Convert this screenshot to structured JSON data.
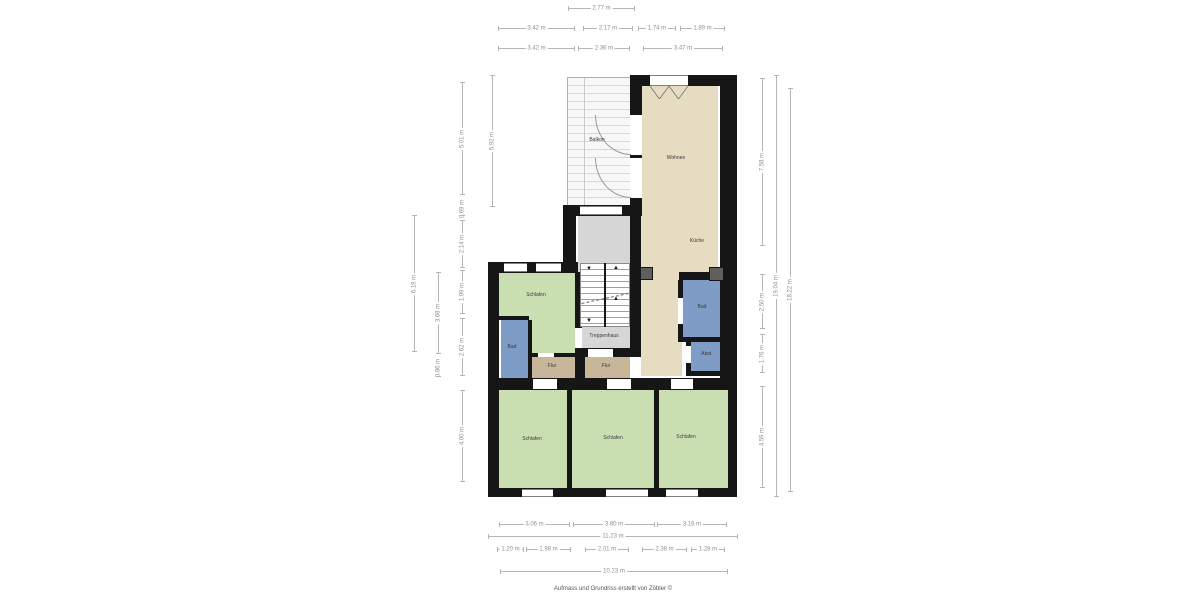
{
  "footer": {
    "credit": "Aufmass und Grundriss erstellt von Zöbler ©"
  },
  "colors": {
    "wall": "#161616",
    "living": "#e5dcc1",
    "bedroom": "#c9dfb2",
    "bath": "#7f9cc6",
    "hall": "#c8b69b",
    "stair": "#d6d6d6",
    "balcony_stripe": "#d8d8d8",
    "chimney": "#5f5f5f",
    "dimline": "#b5b5b5",
    "dimtext": "#8f8f8f",
    "labeltext": "#3a3a3a"
  },
  "plan": {
    "stairs": {
      "up": "▲",
      "down": "▼"
    },
    "areas": [
      {
        "id": "balkon",
        "hatch": true,
        "x": 567,
        "y": 77,
        "w": 63,
        "h": 130
      },
      {
        "id": "wohnen",
        "color": "living",
        "x": 641,
        "y": 85,
        "w": 77,
        "h": 195
      },
      {
        "id": "kueche",
        "color": "living",
        "x": 641,
        "y": 280,
        "w": 41,
        "h": 96
      },
      {
        "id": "schlafen-mitte-a",
        "color": "bedroom",
        "x": 499,
        "y": 273,
        "w": 76,
        "h": 47
      },
      {
        "id": "schlafen-mitte-b",
        "color": "bedroom",
        "x": 532,
        "y": 320,
        "w": 43,
        "h": 33
      },
      {
        "id": "bad-links",
        "color": "bath",
        "x": 501,
        "y": 320,
        "w": 27,
        "h": 58
      },
      {
        "id": "flur-links",
        "color": "hall",
        "x": 532,
        "y": 357,
        "w": 45,
        "h": 21
      },
      {
        "id": "flur-rechts",
        "color": "hall",
        "x": 585,
        "y": 357,
        "w": 45,
        "h": 21
      },
      {
        "id": "treppenhaus",
        "color": "stair",
        "x": 578,
        "y": 216,
        "w": 52,
        "h": 132
      },
      {
        "id": "bad-rechts",
        "color": "bath",
        "x": 683,
        "y": 280,
        "w": 41,
        "h": 57
      },
      {
        "id": "abstellraum",
        "color": "bath",
        "x": 691,
        "y": 342,
        "w": 33,
        "h": 29
      },
      {
        "id": "schlafen-1",
        "color": "bedroom",
        "x": 499,
        "y": 390,
        "w": 68,
        "h": 98
      },
      {
        "id": "schlafen-2",
        "color": "bedroom",
        "x": 572,
        "y": 390,
        "w": 82,
        "h": 98
      },
      {
        "id": "schlafen-3",
        "color": "bedroom",
        "x": 659,
        "y": 389,
        "w": 69,
        "h": 99
      }
    ],
    "labels": [
      {
        "id": "balkon",
        "text": "Balkon",
        "x": 597,
        "y": 140
      },
      {
        "id": "wohnen",
        "text": "Wohnen",
        "x": 676,
        "y": 158
      },
      {
        "id": "kueche",
        "text": "Küche",
        "x": 697,
        "y": 241
      },
      {
        "id": "bad-rechts",
        "text": "Bad",
        "x": 702,
        "y": 307
      },
      {
        "id": "abstellraum",
        "text": "Abst.",
        "x": 707,
        "y": 354
      },
      {
        "id": "schlafen-mitte",
        "text": "Schlafen",
        "x": 536,
        "y": 295
      },
      {
        "id": "bad-links",
        "text": "Bad",
        "x": 512,
        "y": 347
      },
      {
        "id": "treppenhaus",
        "text": "Treppenhaus",
        "x": 604,
        "y": 336
      },
      {
        "id": "flur-links",
        "text": "Flur",
        "x": 552,
        "y": 366
      },
      {
        "id": "flur-rechts",
        "text": "Flur",
        "x": 606,
        "y": 366
      },
      {
        "id": "schlafen-1",
        "text": "Schlafen",
        "x": 532,
        "y": 439
      },
      {
        "id": "schlafen-2",
        "text": "Schlafen",
        "x": 613,
        "y": 438
      },
      {
        "id": "schlafen-3",
        "text": "Schlafen",
        "x": 686,
        "y": 437
      }
    ],
    "dims": [
      {
        "label": "2.77 m",
        "o": "h",
        "x": 568,
        "y": 8,
        "len": 67
      },
      {
        "label": "3.42 m",
        "o": "h",
        "x": 498,
        "y": 28,
        "len": 77
      },
      {
        "label": "2.17 m",
        "o": "h",
        "x": 583,
        "y": 28,
        "len": 50
      },
      {
        "label": "1.74 m",
        "o": "h",
        "x": 638,
        "y": 28,
        "len": 38
      },
      {
        "label": "1.89 m",
        "o": "h",
        "x": 680,
        "y": 28,
        "len": 45
      },
      {
        "label": "3.42 m",
        "o": "h",
        "x": 498,
        "y": 48,
        "len": 77
      },
      {
        "label": "2.36 m",
        "o": "h",
        "x": 578,
        "y": 48,
        "len": 52
      },
      {
        "label": "3.47 m",
        "o": "h",
        "x": 643,
        "y": 48,
        "len": 80
      },
      {
        "label": "3.06 m",
        "o": "h",
        "x": 499,
        "y": 524,
        "len": 71
      },
      {
        "label": "3.80 m",
        "o": "h",
        "x": 573,
        "y": 524,
        "len": 82
      },
      {
        "label": "3.16 m",
        "o": "h",
        "x": 657,
        "y": 524,
        "len": 70
      },
      {
        "label": "11.23 m",
        "o": "h",
        "x": 488,
        "y": 536,
        "len": 250
      },
      {
        "label": "1.20 m",
        "o": "h",
        "x": 497,
        "y": 549,
        "len": 27
      },
      {
        "label": "1.98 m",
        "o": "h",
        "x": 526,
        "y": 549,
        "len": 45
      },
      {
        "label": "2.01 m",
        "o": "h",
        "x": 585,
        "y": 549,
        "len": 44
      },
      {
        "label": "2.38 m",
        "o": "h",
        "x": 642,
        "y": 549,
        "len": 45
      },
      {
        "label": "1.28 m",
        "o": "h",
        "x": 691,
        "y": 549,
        "len": 34
      },
      {
        "label": "10.23 m",
        "o": "h",
        "x": 500,
        "y": 571,
        "len": 228
      },
      {
        "label": "5.92 m",
        "o": "v",
        "x": 492,
        "y": 75,
        "len": 132
      },
      {
        "label": "5.01 m",
        "o": "v",
        "x": 462,
        "y": 82,
        "len": 113
      },
      {
        "label": "0.69 m",
        "o": "v",
        "x": 462,
        "y": 201,
        "len": 15
      },
      {
        "label": "2.14 m",
        "o": "v",
        "x": 462,
        "y": 220,
        "len": 48
      },
      {
        "label": "1.99 m",
        "o": "v",
        "x": 462,
        "y": 270,
        "len": 44
      },
      {
        "label": "2.62 m",
        "o": "v",
        "x": 462,
        "y": 318,
        "len": 58
      },
      {
        "label": "4.00 m",
        "o": "v",
        "x": 462,
        "y": 390,
        "len": 92
      },
      {
        "label": "3.68 m",
        "o": "v",
        "x": 438,
        "y": 272,
        "len": 82
      },
      {
        "label": "0.86 m",
        "o": "v",
        "x": 438,
        "y": 358,
        "len": 19
      },
      {
        "label": "6.18 m",
        "o": "v",
        "x": 414,
        "y": 215,
        "len": 137
      },
      {
        "label": "7.58 m",
        "o": "v",
        "x": 762,
        "y": 78,
        "len": 168
      },
      {
        "label": "2.50 m",
        "o": "v",
        "x": 762,
        "y": 274,
        "len": 55
      },
      {
        "label": "1.76 m",
        "o": "v",
        "x": 762,
        "y": 334,
        "len": 39
      },
      {
        "label": "4.59 m",
        "o": "v",
        "x": 762,
        "y": 386,
        "len": 102
      },
      {
        "label": "19.04 m",
        "o": "v",
        "x": 776,
        "y": 75,
        "len": 422
      },
      {
        "label": "18.22 m",
        "o": "v",
        "x": 790,
        "y": 88,
        "len": 404
      }
    ]
  }
}
